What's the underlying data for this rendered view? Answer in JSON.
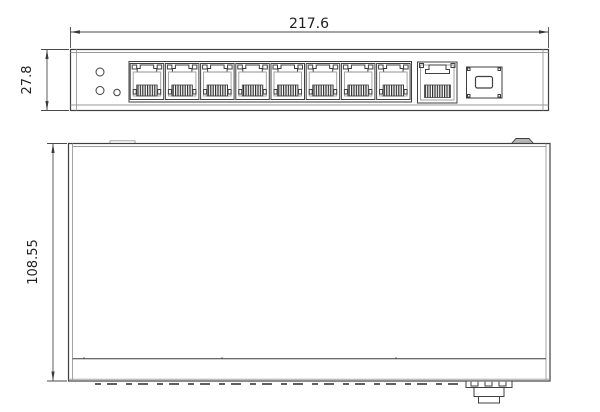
{
  "dimensions": {
    "width": "217.6",
    "front_height": "27.8",
    "depth": "108.55"
  },
  "front_view": {
    "lan_port_count": 8,
    "uplink_port_count": 1,
    "sfp_port_count": 1,
    "led_indicator_count": 3
  },
  "colors": {
    "line": "#3f3f3f",
    "line_light": "#9a9a9a",
    "background": "#ffffff",
    "ground_lug_fill": "#b5b5b5"
  }
}
